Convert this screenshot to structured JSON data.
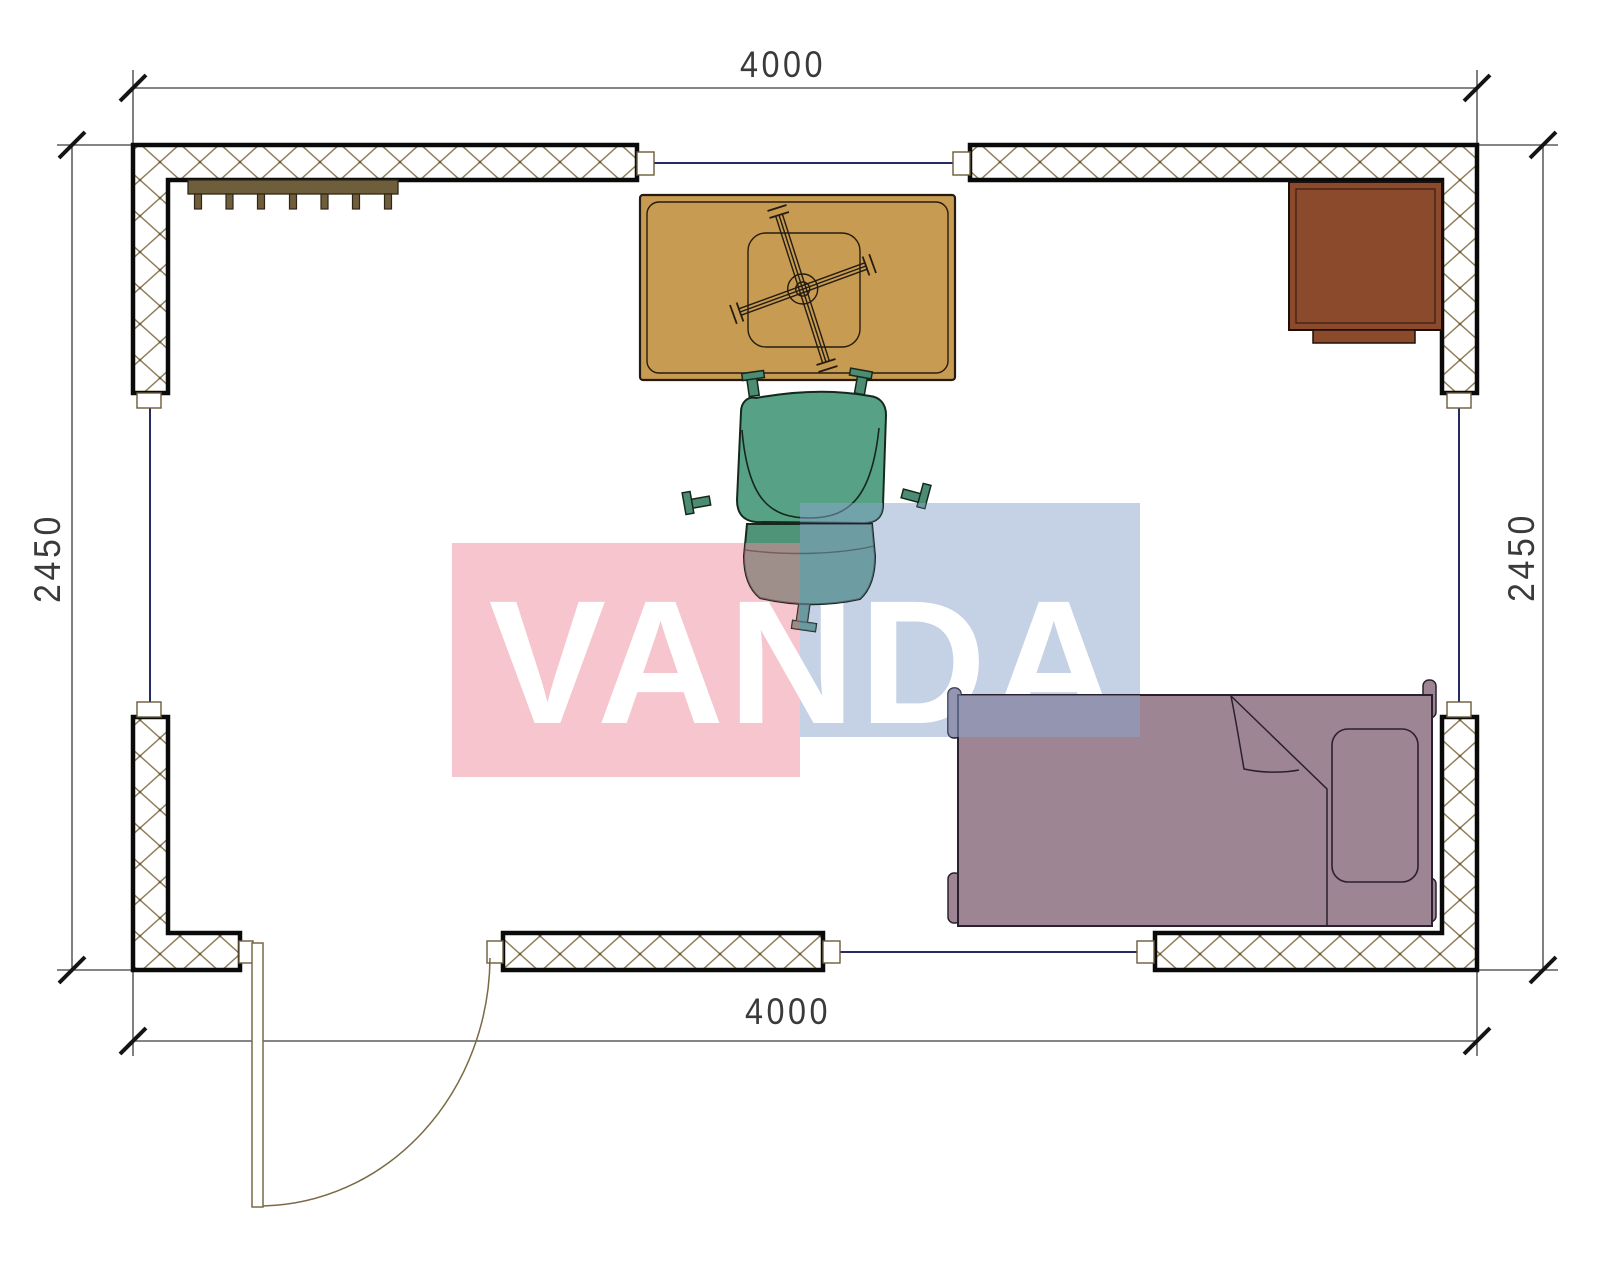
{
  "plan": {
    "title": "Room floor plan",
    "room_width_mm": 4000,
    "room_depth_mm": 2450,
    "dimensions": {
      "top": "4000",
      "bottom": "4000",
      "left": "2450",
      "right": "2450"
    },
    "furniture": [
      "coat-rack",
      "table-with-cross-base",
      "office-chair",
      "desk",
      "single-bed",
      "door"
    ]
  },
  "watermark": {
    "text": "VANDA",
    "text_color": "#ffffff",
    "pink_block": "rgba(238,140,155,0.5)",
    "blue_block": "rgba(140,165,205,0.5)"
  },
  "colors": {
    "wall_outline": "#0a0a0a",
    "wall_hatch": "#8f7d57",
    "window_line": "#272a63",
    "dimension_line": "#3c3c3c",
    "coat_rack": "#6e5e3c",
    "table": "#c79b51",
    "desk": "#8b4a2b",
    "desk_tab": "#8b4a2b",
    "chair_seat": "#57a287",
    "chair_back": "#4f9378",
    "chair_caster": "#4b8c72",
    "bed": "#9d8593",
    "door": "#7a6a45"
  }
}
